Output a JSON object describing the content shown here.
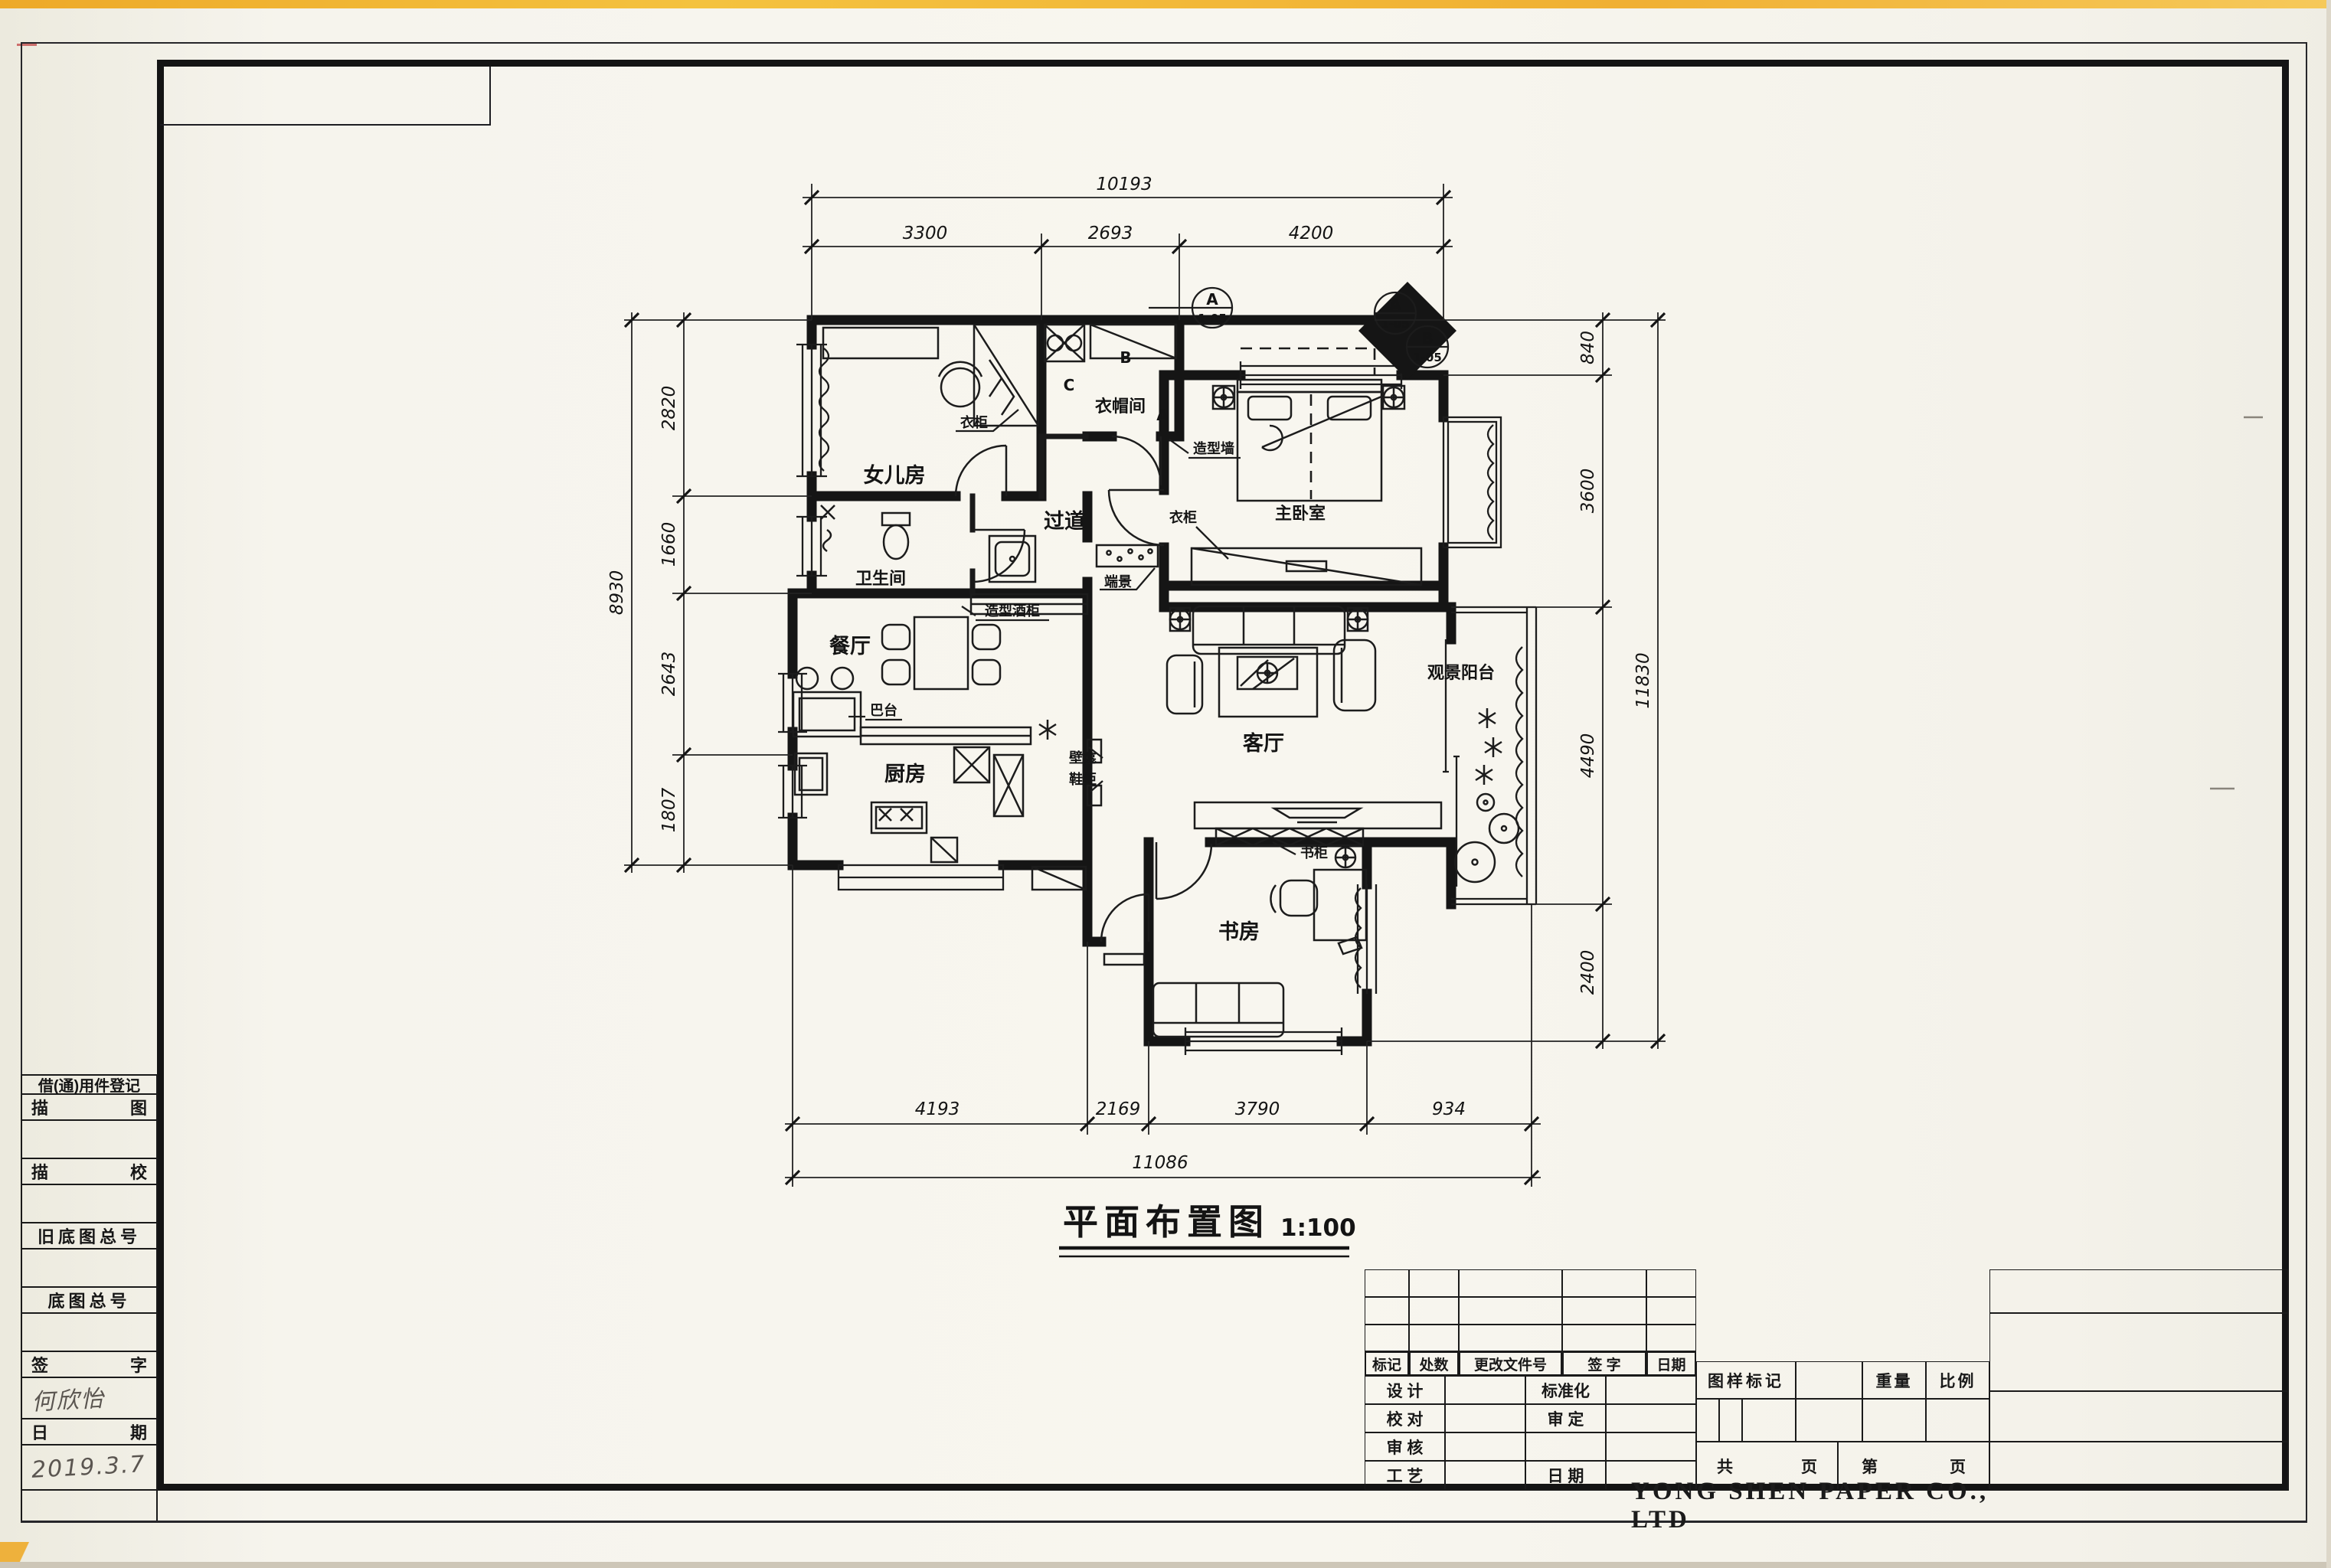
{
  "document": {
    "title": "平面布置图",
    "scale": "1:100",
    "company": "YONG SHEN PAPER CO., LTD"
  },
  "rooms": {
    "daughter_room": "女儿房",
    "cloakroom": "衣帽间",
    "corridor": "过道",
    "bathroom": "卫生间",
    "master_bedroom": "主卧室",
    "dining_room": "餐厅",
    "kitchen": "厨房",
    "living_room": "客厅",
    "view_balcony": "观景阳台",
    "study": "书房"
  },
  "labels": {
    "wardrobe_daughter": "衣柜",
    "wardrobe_master": "衣柜",
    "end_scene": "端景",
    "feature_wall": "造型墙",
    "feature_wine_cabinet": "造型酒柜",
    "bar_counter": "巴台",
    "wall_niche": "壁龛",
    "shoe_cabinet": "鞋柜",
    "bookcase": "书柜"
  },
  "dimensions": {
    "top": {
      "total": "10193",
      "segments": [
        "3300",
        "2693",
        "4200"
      ]
    },
    "left": {
      "total": "8930",
      "segments": [
        "2820",
        "1660",
        "2643",
        "1807"
      ]
    },
    "right": {
      "total": "11830",
      "segments": [
        "840",
        "3600",
        "4490",
        "2400"
      ]
    },
    "bottom": {
      "total": "11086",
      "segments": [
        "4193",
        "2169",
        "3790",
        "934"
      ]
    }
  },
  "section_markers": {
    "m1": {
      "letter": "A",
      "ref": "1-05"
    },
    "m2": {
      "letter": "A",
      "ref": "1-05"
    },
    "m3": {
      "letter": "B",
      "ref": "1-05"
    },
    "elevation_letters": {
      "a": "A",
      "b": "B",
      "c": "C"
    }
  },
  "sidebar": {
    "register_header": "借(通)用件登记",
    "rows": [
      {
        "left": "描",
        "right": "图",
        "value": ""
      },
      {
        "left": "描",
        "right": "校",
        "value": ""
      },
      {
        "label": "旧底图总号",
        "value": ""
      },
      {
        "label": "底图总号",
        "value": ""
      },
      {
        "left": "签",
        "right": "字",
        "value": "何欣怡"
      },
      {
        "left": "日",
        "right": "期",
        "value": "2019.3.7"
      }
    ]
  },
  "title_block": {
    "header_row": [
      "标记",
      "处数",
      "更改文件号",
      "签  字",
      "日期"
    ],
    "left_rows": [
      {
        "l1": "设  计",
        "l2": "标准化"
      },
      {
        "l1": "校  对",
        "l2": "审  定"
      },
      {
        "l1": "审  核",
        "l2": ""
      },
      {
        "l1": "工  艺",
        "l2": "日  期"
      }
    ],
    "drawing_mark": "图样标记",
    "weight": "重量",
    "scale_label": "比例",
    "total_label": "共",
    "page_label": "页",
    "sheet_label": "第",
    "page_label2": "页"
  }
}
